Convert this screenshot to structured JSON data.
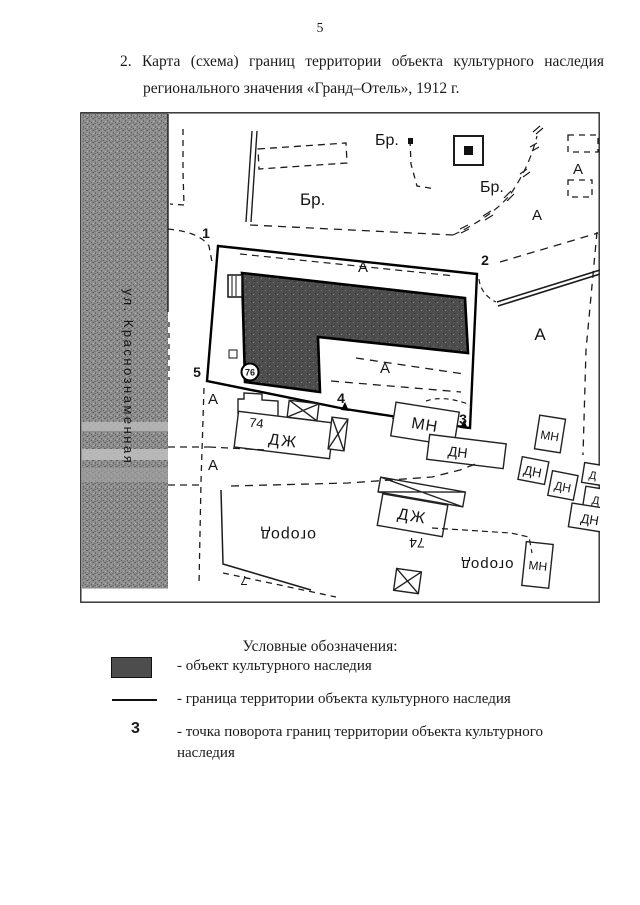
{
  "page": {
    "number": "5"
  },
  "heading": {
    "line1": "2. Карта (схема) границ территории объекта культурного наследия",
    "line2": "регионального значения «Гранд–Отель», 1912 г."
  },
  "map": {
    "street_label": "ул. Краснознаменная",
    "points": [
      "1",
      "2",
      "3",
      "4",
      "5"
    ],
    "object_point": "76",
    "br_labels": [
      "Бр.",
      "Бр.",
      "Бр."
    ],
    "a_labels": [
      "А",
      "А",
      "А",
      "А",
      "А",
      "А",
      "А"
    ],
    "mn_labels": [
      "МН",
      "МН",
      "МН"
    ],
    "dn_labels": [
      "ДН",
      "ДН",
      "ДН",
      "ДН"
    ],
    "d_labels": [
      "Д",
      "Д"
    ],
    "dzh_labels": [
      "ДЖ",
      "ДЖ"
    ],
    "house_numbers": [
      "74",
      "74"
    ],
    "garden_labels": [
      "огород",
      "огород"
    ],
    "parcel7": "7"
  },
  "legend": {
    "title": "Условные обозначения:",
    "items": [
      {
        "label": "- объект культурного наследия"
      },
      {
        "label": "- граница территории объекта культурного наследия"
      },
      {
        "symbol": "3",
        "label": "- точка поворота границ территории объекта культурного наследия"
      }
    ]
  },
  "colors": {
    "object_fill": "#4d4d4d",
    "street_band": "#8e8e8e",
    "ink": "#1a1a1a"
  }
}
